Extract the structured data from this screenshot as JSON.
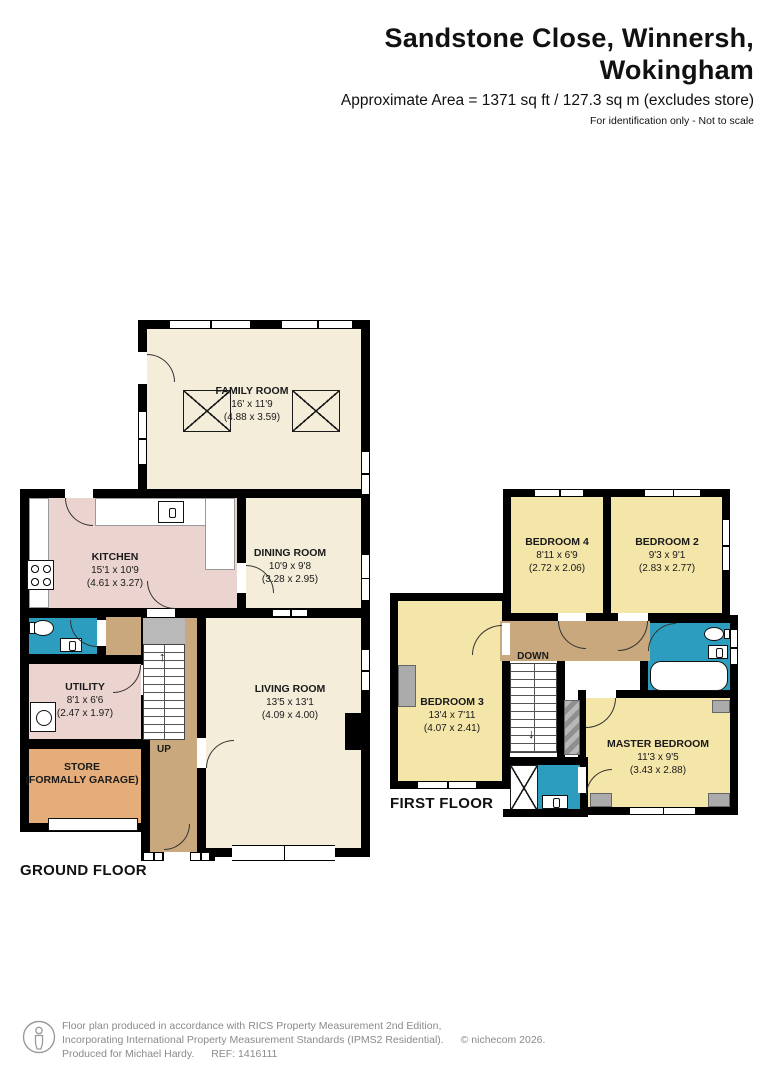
{
  "header": {
    "title": "Sandstone Close, Winnersh, Wokingham",
    "subtitle": "Approximate Area = 1371 sq ft / 127.3 sq m (excludes store)",
    "disclaimer": "For identification only - Not to scale"
  },
  "ground_floor": {
    "label": "GROUND FLOOR",
    "stairs_label": "UP",
    "rooms": {
      "family": {
        "name": "FAMILY ROOM",
        "imperial": "16' x 11'9",
        "metric": "(4.88 x 3.59)"
      },
      "kitchen": {
        "name": "KITCHEN",
        "imperial": "15'1 x 10'9",
        "metric": "(4.61 x 3.27)"
      },
      "dining": {
        "name": "DINING ROOM",
        "imperial": "10'9 x 9'8",
        "metric": "(3.28 x 2.95)"
      },
      "utility": {
        "name": "UTILITY",
        "imperial": "8'1 x 6'6",
        "metric": "(2.47 x 1.97)"
      },
      "living": {
        "name": "LIVING ROOM",
        "imperial": "13'5 x 13'1",
        "metric": "(4.09 x 4.00)"
      },
      "store": {
        "name": "STORE",
        "name2": "(FORMALLY GARAGE)"
      }
    }
  },
  "first_floor": {
    "label": "FIRST FLOOR",
    "stairs_label": "DOWN",
    "rooms": {
      "bedroom4": {
        "name": "BEDROOM 4",
        "imperial": "8'11 x 6'9",
        "metric": "(2.72 x 2.06)"
      },
      "bedroom2": {
        "name": "BEDROOM 2",
        "imperial": "9'3 x 9'1",
        "metric": "(2.83 x 2.77)"
      },
      "bedroom3": {
        "name": "BEDROOM 3",
        "imperial": "13'4 x 7'11",
        "metric": "(4.07 x 2.41)"
      },
      "master": {
        "name": "MASTER BEDROOM",
        "imperial": "11'3 x 9'5",
        "metric": "(3.43 x 2.88)"
      }
    }
  },
  "footer": {
    "line1": "Floor plan produced in accordance with RICS Property Measurement 2nd Edition,",
    "line2": "Incorporating International Property Measurement Standards (IPMS2 Residential).",
    "copyright": "© nichecom 2026.",
    "line3": "Produced for Michael Hardy.",
    "ref": "REF: 1416111"
  },
  "colors": {
    "wall": "#000000",
    "floor_cream": "#F3EDD9",
    "floor_pink": "#EBD4CF",
    "floor_yellow": "#F4E5A9",
    "floor_blue": "#2D9DBF",
    "floor_tan": "#C9A87D",
    "floor_store": "#E5AD79"
  }
}
